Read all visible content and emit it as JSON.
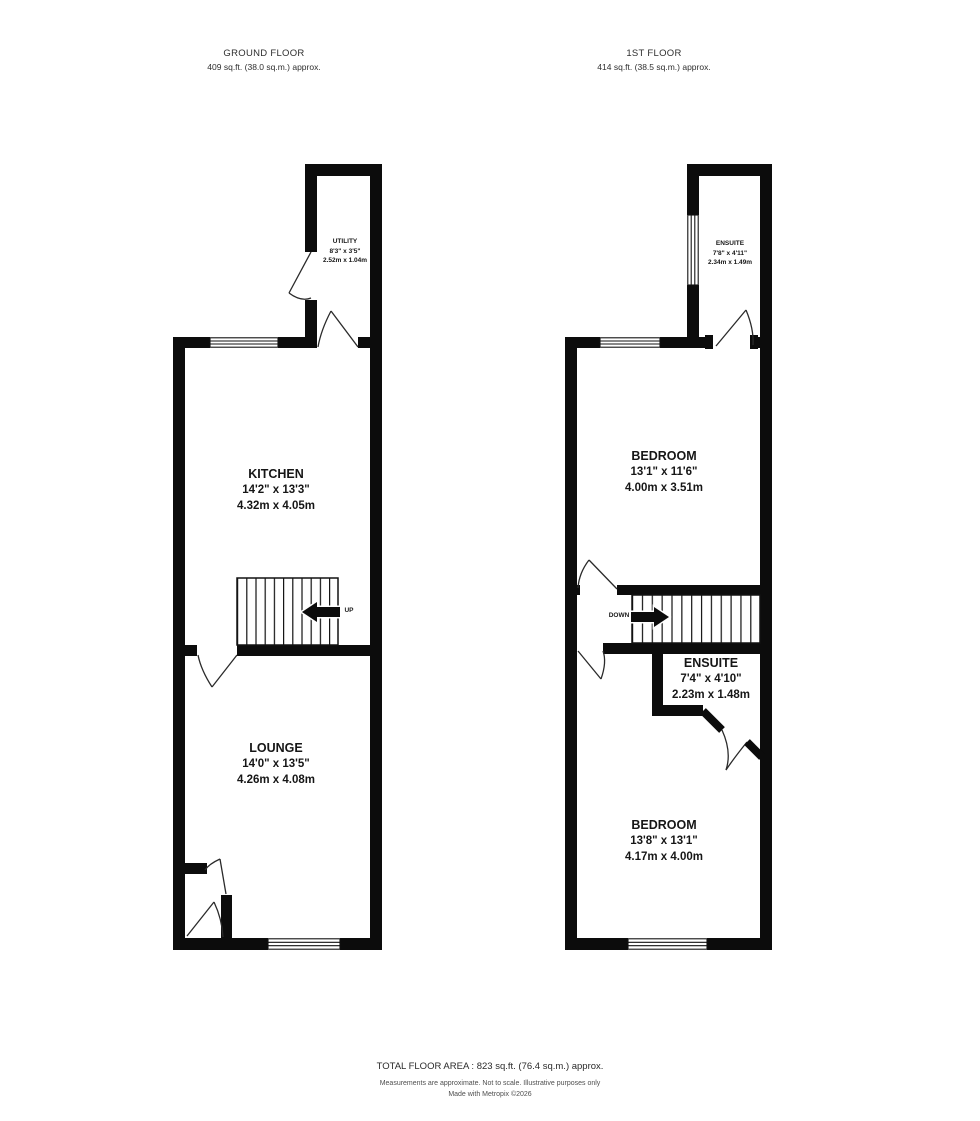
{
  "colors": {
    "wall": "#0c0c0c",
    "text": "#161616",
    "background": "#ffffff"
  },
  "ground_floor": {
    "header": {
      "title": "GROUND FLOOR",
      "area": "409 sq.ft. (38.0 sq.m.) approx."
    },
    "stairs_label": "UP",
    "rooms": {
      "utility": {
        "name": "UTILITY",
        "imperial": "8'3\" x 3'5\"",
        "metric": "2.52m x 1.04m"
      },
      "kitchen": {
        "name": "KITCHEN",
        "imperial": "14'2\" x 13'3\"",
        "metric": "4.32m x 4.05m"
      },
      "lounge": {
        "name": "LOUNGE",
        "imperial": "14'0\" x 13'5\"",
        "metric": "4.26m x 4.08m"
      }
    }
  },
  "first_floor": {
    "header": {
      "title": "1ST FLOOR",
      "area": "414 sq.ft. (38.5 sq.m.) approx."
    },
    "stairs_label": "DOWN",
    "rooms": {
      "ensuite_top": {
        "name": "ENSUITE",
        "imperial": "7'8\" x 4'11\"",
        "metric": "2.34m x 1.49m"
      },
      "bedroom_1": {
        "name": "BEDROOM",
        "imperial": "13'1\" x 11'6\"",
        "metric": "4.00m x 3.51m"
      },
      "ensuite_mid": {
        "name": "ENSUITE",
        "imperial": "7'4\" x 4'10\"",
        "metric": "2.23m x 1.48m"
      },
      "bedroom_2": {
        "name": "BEDROOM",
        "imperial": "13'8\" x 13'1\"",
        "metric": "4.17m x 4.00m"
      }
    }
  },
  "footer": {
    "total": "TOTAL FLOOR AREA : 823 sq.ft. (76.4 sq.m.) approx.",
    "disclaimer": "Measurements are approximate. Not to scale. Illustrative purposes only",
    "credit": "Made with Metropix ©2026"
  }
}
